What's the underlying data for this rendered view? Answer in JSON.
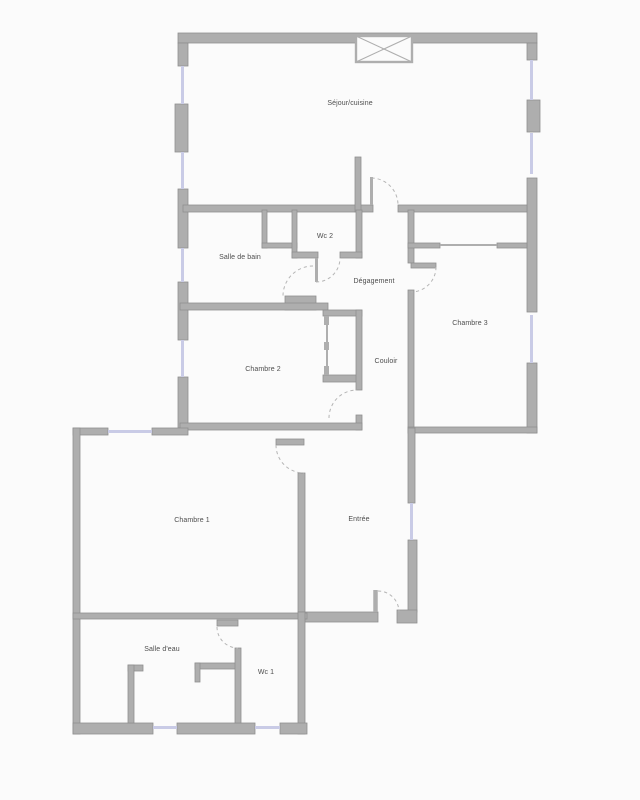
{
  "floor_plan": {
    "colors": {
      "background": "#fbfbfb",
      "wall": "#aeaeae",
      "wall_edge": "#8f8f8f",
      "window": "#c9cbe6",
      "door_arc": "#b5b5b5",
      "text": "#4d4d4d"
    },
    "rooms": [
      {
        "id": "sejour-cuisine",
        "label": "Séjour/cuisine",
        "cx": 350,
        "cy": 104
      },
      {
        "id": "salle-de-bain",
        "label": "Salle de bain",
        "cx": 240,
        "cy": 258
      },
      {
        "id": "wc-2",
        "label": "Wc 2",
        "cx": 325,
        "cy": 237
      },
      {
        "id": "degagement",
        "label": "Dégagement",
        "cx": 374,
        "cy": 282
      },
      {
        "id": "chambre-3",
        "label": "Chambre 3",
        "cx": 470,
        "cy": 324
      },
      {
        "id": "chambre-2",
        "label": "Chambre 2",
        "cx": 263,
        "cy": 370
      },
      {
        "id": "couloir",
        "label": "Couloir",
        "cx": 386,
        "cy": 362
      },
      {
        "id": "chambre-1",
        "label": "Chambre 1",
        "cx": 192,
        "cy": 521
      },
      {
        "id": "entree",
        "label": "Entrée",
        "cx": 359,
        "cy": 520
      },
      {
        "id": "salle-d-eau",
        "label": "Salle d'eau",
        "cx": 162,
        "cy": 650
      },
      {
        "id": "wc-1",
        "label": "Wc 1",
        "cx": 266,
        "cy": 673
      }
    ]
  }
}
